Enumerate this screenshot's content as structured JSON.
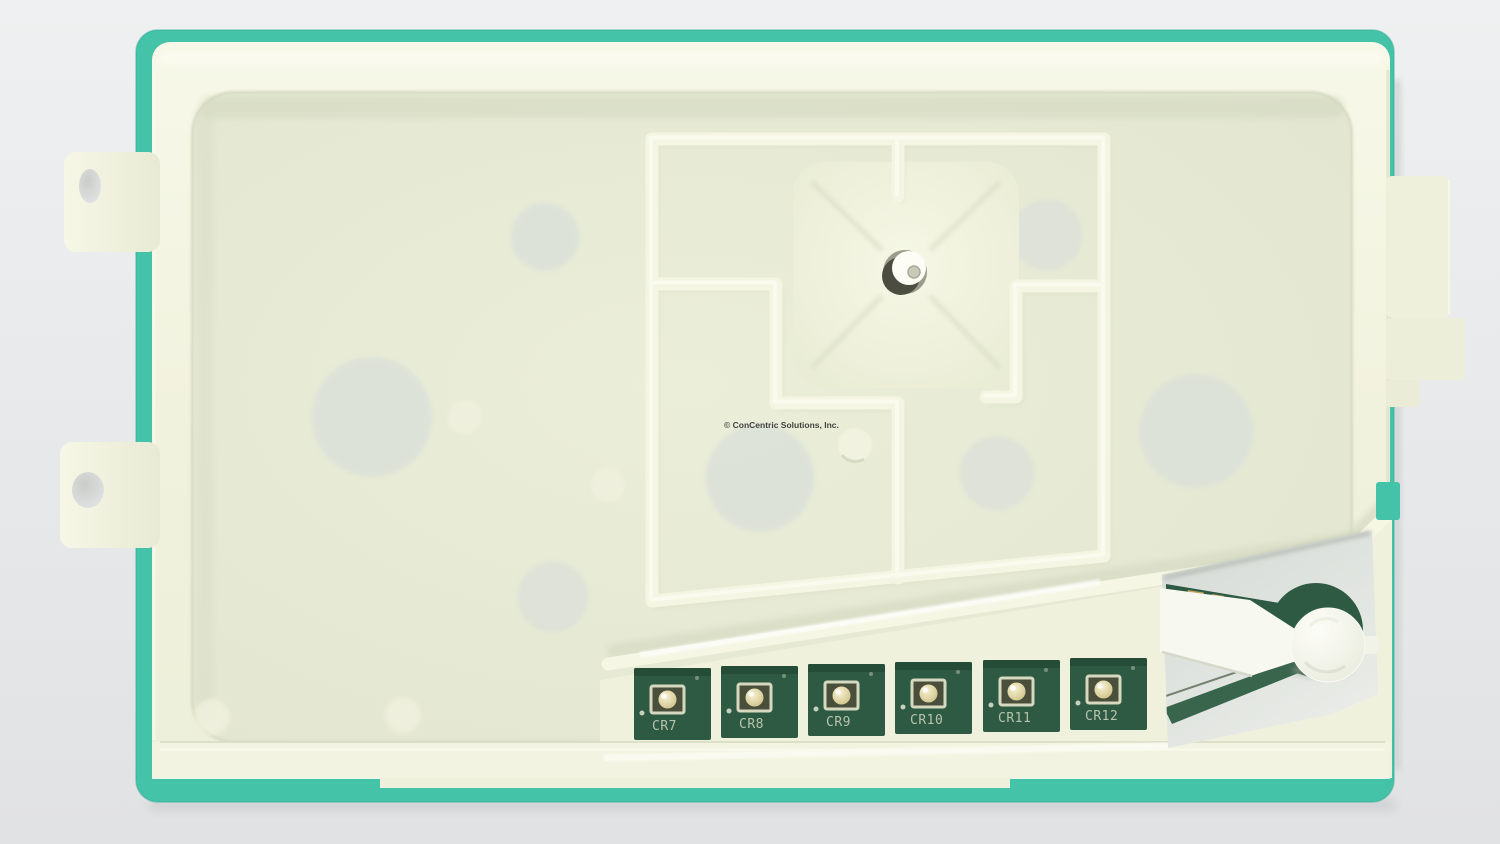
{
  "photo": {
    "subject": "Appliance control board in molded plastic cover",
    "watermark": "© ConCentric Solutions, Inc."
  },
  "leds": [
    "CR7",
    "CR8",
    "CR9",
    "CR10",
    "CR11",
    "CR12"
  ],
  "colors": {
    "background": "#e9ebec",
    "board_teal": "#44c3a9",
    "housing_cream": "#f2f3df",
    "panel_cream": "#e7ead5",
    "rib_cream": "#f4f5e2",
    "pcb_green": "#2e5a43",
    "pcb_green_light": "#3a654d",
    "led_dome": "#e9dfae",
    "silkscreen": "#b7c3ad",
    "knob_white": "#f9faf2"
  }
}
